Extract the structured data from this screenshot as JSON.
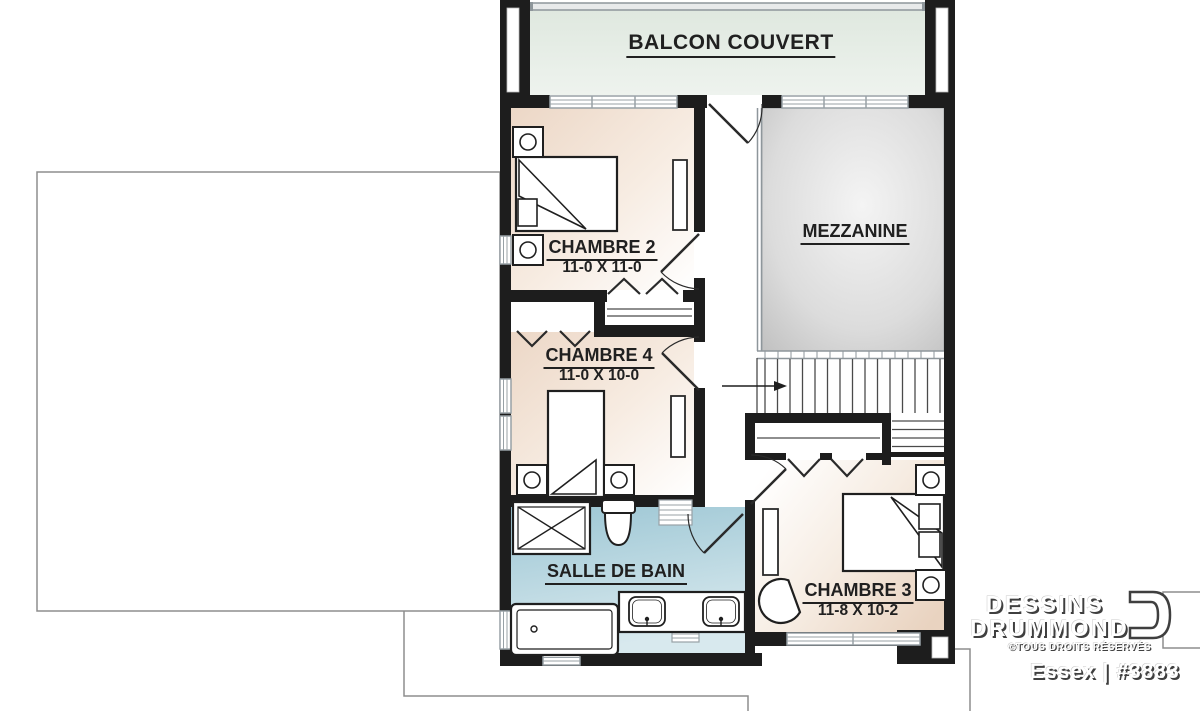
{
  "plan": {
    "rooms": {
      "balcon": {
        "label": "BALCON COUVERT"
      },
      "chambre2": {
        "label": "CHAMBRE 2",
        "dims": "11-0 X 11-0"
      },
      "mezzanine": {
        "label": "MEZZANINE"
      },
      "chambre4": {
        "label": "CHAMBRE 4",
        "dims": "11-0 X 10-0"
      },
      "salle_de_bain": {
        "label": "SALLE DE BAIN"
      },
      "chambre3": {
        "label": "CHAMBRE 3",
        "dims": "11-8 X 10-2"
      }
    }
  },
  "branding": {
    "company_top": "DESSINS",
    "company_bottom": "DRUMMOND",
    "rights": "©TOUS DROITS RÉSERVÉS",
    "plan_ref": "Essex | #3883"
  },
  "colors": {
    "wall": "#1d1d1d",
    "label_text": "#202020",
    "window_frame": "#98a1a6",
    "roof_outline": "#8d8d8d",
    "bedroom_dark": "#ecd7c6",
    "bedroom_light": "#ffffff",
    "bathroom_dark": "#9cc6d4",
    "bathroom_light": "#d8e9ee",
    "balcony_dark": "#dfe8df",
    "balcony_light": "#eef3ee",
    "mezzanine_dark": "#bdbdbd",
    "mezzanine_light": "#f4f4f4",
    "logo_text": "#ffffff",
    "logo_shadow": "#3f3f3f"
  }
}
